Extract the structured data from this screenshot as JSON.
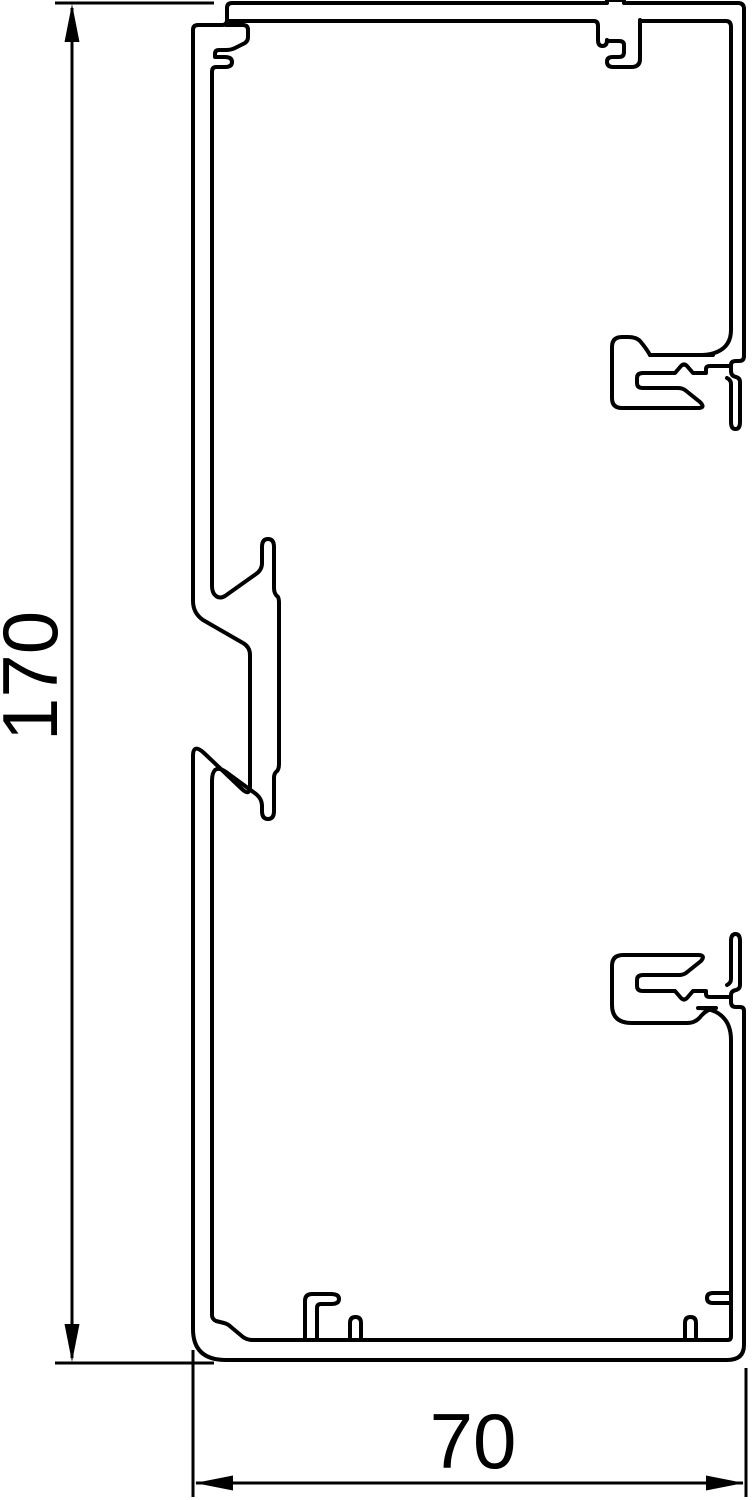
{
  "drawing": {
    "type": "technical-cross-section",
    "subject": "cable trunking profile cross-section",
    "background_color": "#ffffff",
    "line_color": "#000000"
  },
  "dimensions": {
    "height": {
      "label": "170",
      "orientation": "vertical"
    },
    "width": {
      "label": "70",
      "orientation": "horizontal"
    }
  }
}
